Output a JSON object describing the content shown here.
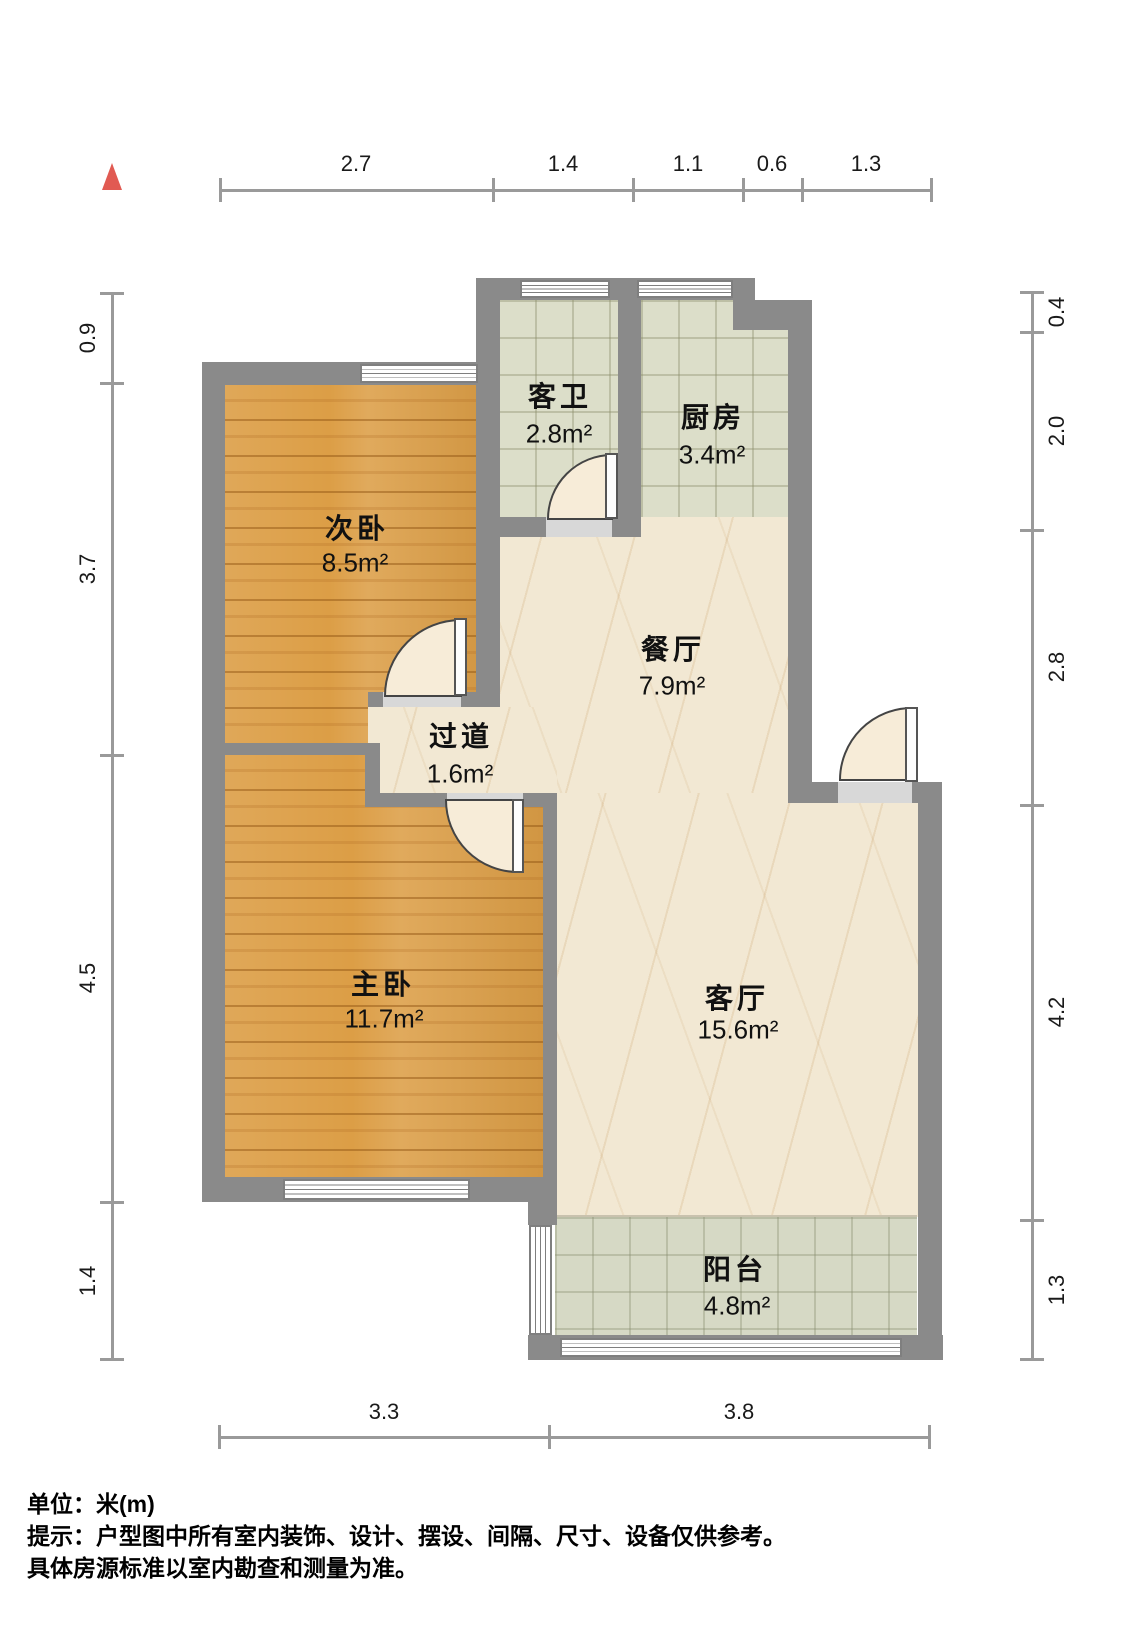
{
  "title": "户型图",
  "dims": {
    "top": [
      "2.7",
      "1.4",
      "1.1",
      "0.6",
      "1.3"
    ],
    "left": [
      "0.9",
      "3.7",
      "4.5",
      "1.4"
    ],
    "right": [
      "0.4",
      "2.0",
      "2.8",
      "4.2",
      "1.3"
    ],
    "bottom": [
      "3.3",
      "3.8"
    ]
  },
  "rooms": [
    {
      "name": "次卧",
      "area": "8.5m²"
    },
    {
      "name": "客卫",
      "area": "2.8m²"
    },
    {
      "name": "厨房",
      "area": "3.4m²"
    },
    {
      "name": "餐厅",
      "area": "7.9m²"
    },
    {
      "name": "过道",
      "area": "1.6m²"
    },
    {
      "name": "主卧",
      "area": "11.7m²"
    },
    {
      "name": "客厅",
      "area": "15.6m²"
    },
    {
      "name": "阳台",
      "area": "4.8m²"
    }
  ],
  "footer": {
    "line1": "单位：米(m)",
    "line2": "提示：户型图中所有室内装饰、设计、摆设、间隔、尺寸、设备仅供参考。",
    "line3": "具体房源标准以室内勘查和测量为准。"
  },
  "colors": {
    "wall": "#8a8a8a",
    "wood_floor": "#dc9e46",
    "tile_floor": "#dcdec9",
    "balcony_tile": "#d6d9c5",
    "marble_floor": "#f2e8d3",
    "north_arrow": "#e15a52",
    "dimension_line": "#9a9a9a",
    "door_fan": "#f7ecd8"
  }
}
